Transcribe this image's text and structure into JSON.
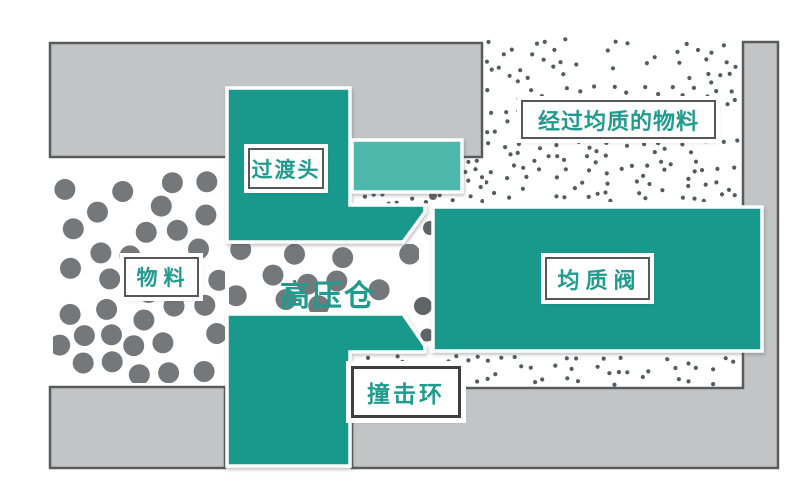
{
  "labels": {
    "material": "物料",
    "high_pressure_chamber": "高压仓",
    "transition_head": "过渡头",
    "homogenizing_valve": "均质阀",
    "impact_ring": "撞击环",
    "homogenized_material": "经过均质的物料"
  },
  "colors": {
    "background": "#ffffff",
    "teal": "#18998c",
    "teal_light": "#4eb8ac",
    "gray_fill": "#c3c4c5",
    "gray_border": "#5b5b5b",
    "label_text": "#219b8e",
    "label_border": "#575757",
    "impact_label_border": "#3f3f3f",
    "outline_white": "#ffffff",
    "particle_large": "#74787b",
    "particle_small": "#565b5e",
    "squeezed_particle": "#5f6467"
  },
  "particles": {
    "large": {
      "meaning": "raw un-homogenized material (big particles)",
      "color": "#74787b",
      "radius": 10.5,
      "fields": [
        {
          "name": "inlet-material",
          "x": 53,
          "y": 159,
          "w": 172,
          "h": 224,
          "count": 34
        },
        {
          "name": "chamber-material",
          "x": 229,
          "y": 244,
          "w": 190,
          "h": 68,
          "count": 11
        }
      ]
    },
    "small": {
      "meaning": "homogenized material (fine particles)",
      "color": "#565b5e",
      "radius": 2.1,
      "fields": [
        {
          "name": "outlet-top",
          "x": 485,
          "y": 36,
          "w": 256,
          "h": 166,
          "count": 175
        },
        {
          "name": "outlet-top-left-notch",
          "x": 463,
          "y": 158,
          "w": 21,
          "h": 45,
          "count": 9
        },
        {
          "name": "seat-gap-strip",
          "x": 355,
          "y": 193,
          "w": 108,
          "h": 12,
          "count": 9
        },
        {
          "name": "outlet-bottom-strip",
          "x": 353,
          "y": 354,
          "w": 389,
          "h": 33,
          "count": 55
        }
      ]
    },
    "squeezed": {
      "meaning": "particles being forced through the valve gap",
      "color": "#5f6467",
      "points": [
        {
          "x": 430,
          "y": 228,
          "r": 7
        },
        {
          "x": 423,
          "y": 306,
          "r": 9
        },
        {
          "x": 427,
          "y": 335,
          "r": 6.5
        },
        {
          "x": 433,
          "y": 196,
          "r": 4
        }
      ]
    }
  }
}
